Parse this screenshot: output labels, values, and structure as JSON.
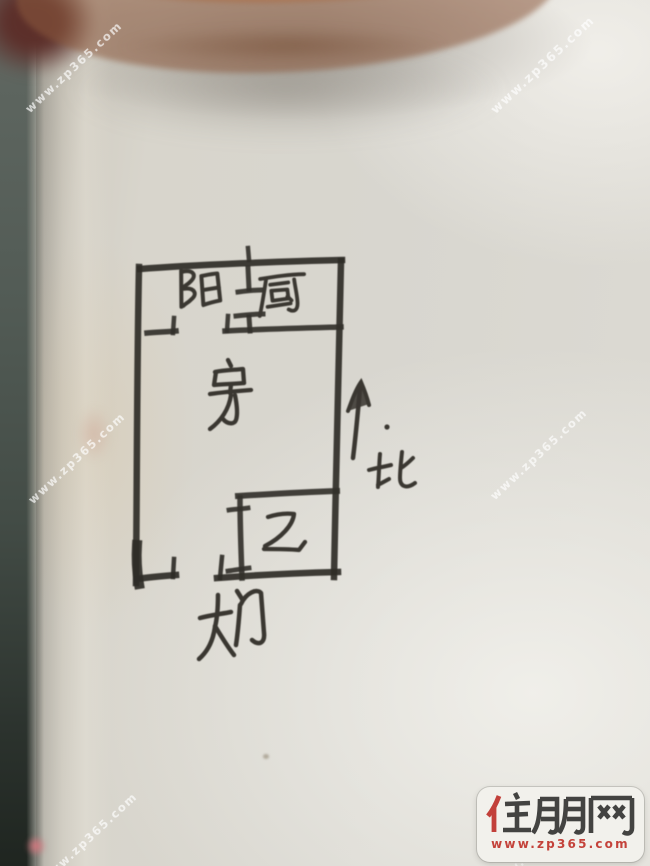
{
  "watermark": {
    "text": "www.zp365.com"
  },
  "logo": {
    "brand": "住朋网",
    "url": "www.zp365.com",
    "colors": {
      "accent": "#c2403a",
      "text": "#434341",
      "background": "#f2f1ec"
    }
  },
  "floor_plan": {
    "rooms": [
      {
        "id": "balcony",
        "label": "阳"
      },
      {
        "id": "kitchen",
        "label": "厨"
      },
      {
        "id": "room",
        "label": "房"
      },
      {
        "id": "bathroom",
        "label": "卫"
      }
    ],
    "entrance": {
      "label": "大门"
    },
    "compass": {
      "label": "北",
      "direction": "up"
    }
  },
  "palette": {
    "ink": "#37352f",
    "paper": "#d8d6cf",
    "background_strip": "#3c463f",
    "finger": "#d2a083"
  }
}
